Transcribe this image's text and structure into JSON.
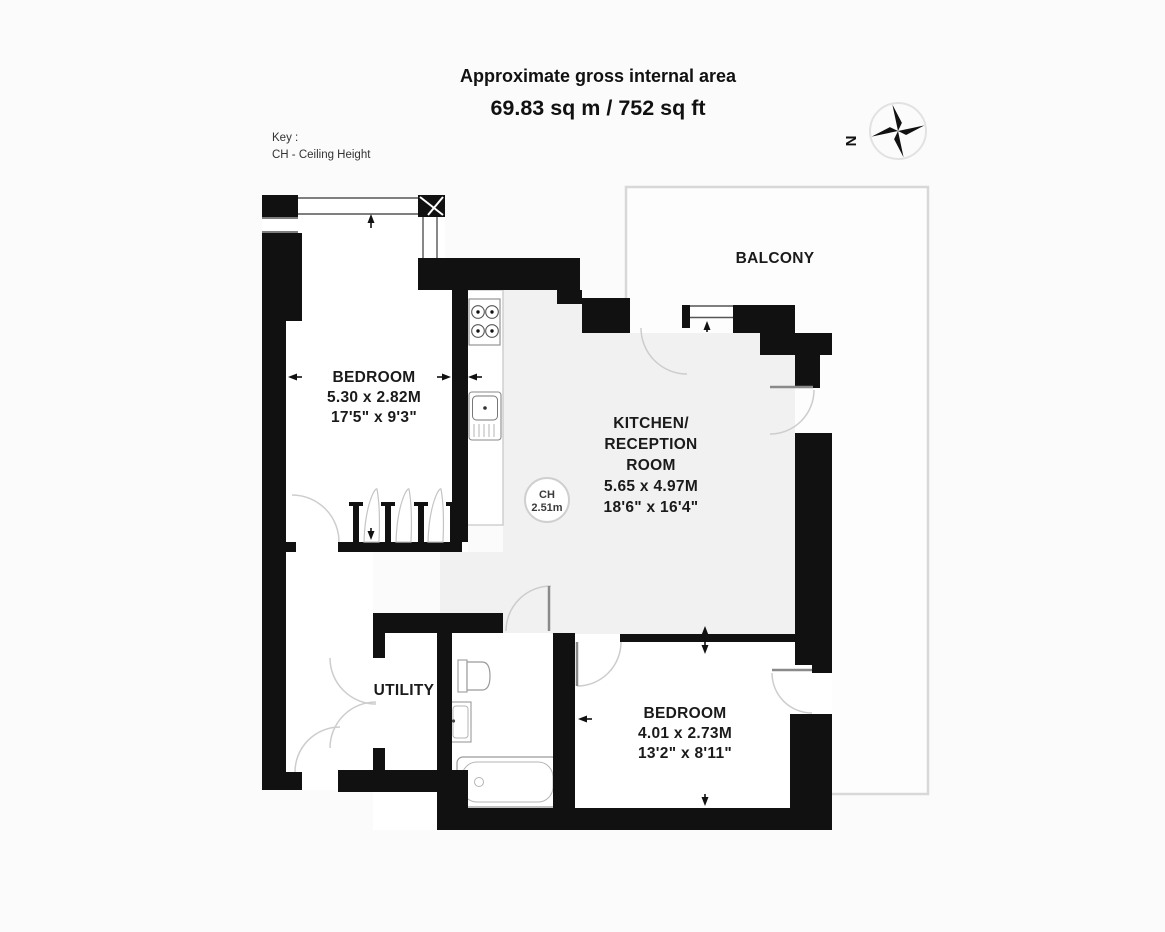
{
  "title": {
    "line1": "Approximate gross internal area",
    "line2": "69.83 sq m / 752 sq ft"
  },
  "key": {
    "line1": "Key :",
    "line2": "CH - Ceiling Height"
  },
  "compass": {
    "north": "N"
  },
  "rooms": {
    "balcony": {
      "label": "BALCONY"
    },
    "utility": {
      "label": "UTILITY"
    },
    "bedroom1": {
      "label": "BEDROOM",
      "metric": "5.30 x 2.82M",
      "imperial": "17'5\" x 9'3\""
    },
    "kitchen": {
      "label1": "KITCHEN/",
      "label2": "RECEPTION",
      "label3": "ROOM",
      "metric": "5.65 x 4.97M",
      "imperial": "18'6\" x 16'4\""
    },
    "bedroom2": {
      "label": "BEDROOM",
      "metric": "4.01 x 2.73M",
      "imperial": "13'2\" x 8'11\""
    }
  },
  "ceiling_height": {
    "abbr": "CH",
    "value": "2.51m"
  },
  "colors": {
    "wall": "#111111",
    "kitchen_floor": "#f1f1f1",
    "balcony_border": "#d8d8d8",
    "door_arc": "#cdcdcd",
    "text": "#1a1a1a",
    "background": "#fbfbfb"
  }
}
